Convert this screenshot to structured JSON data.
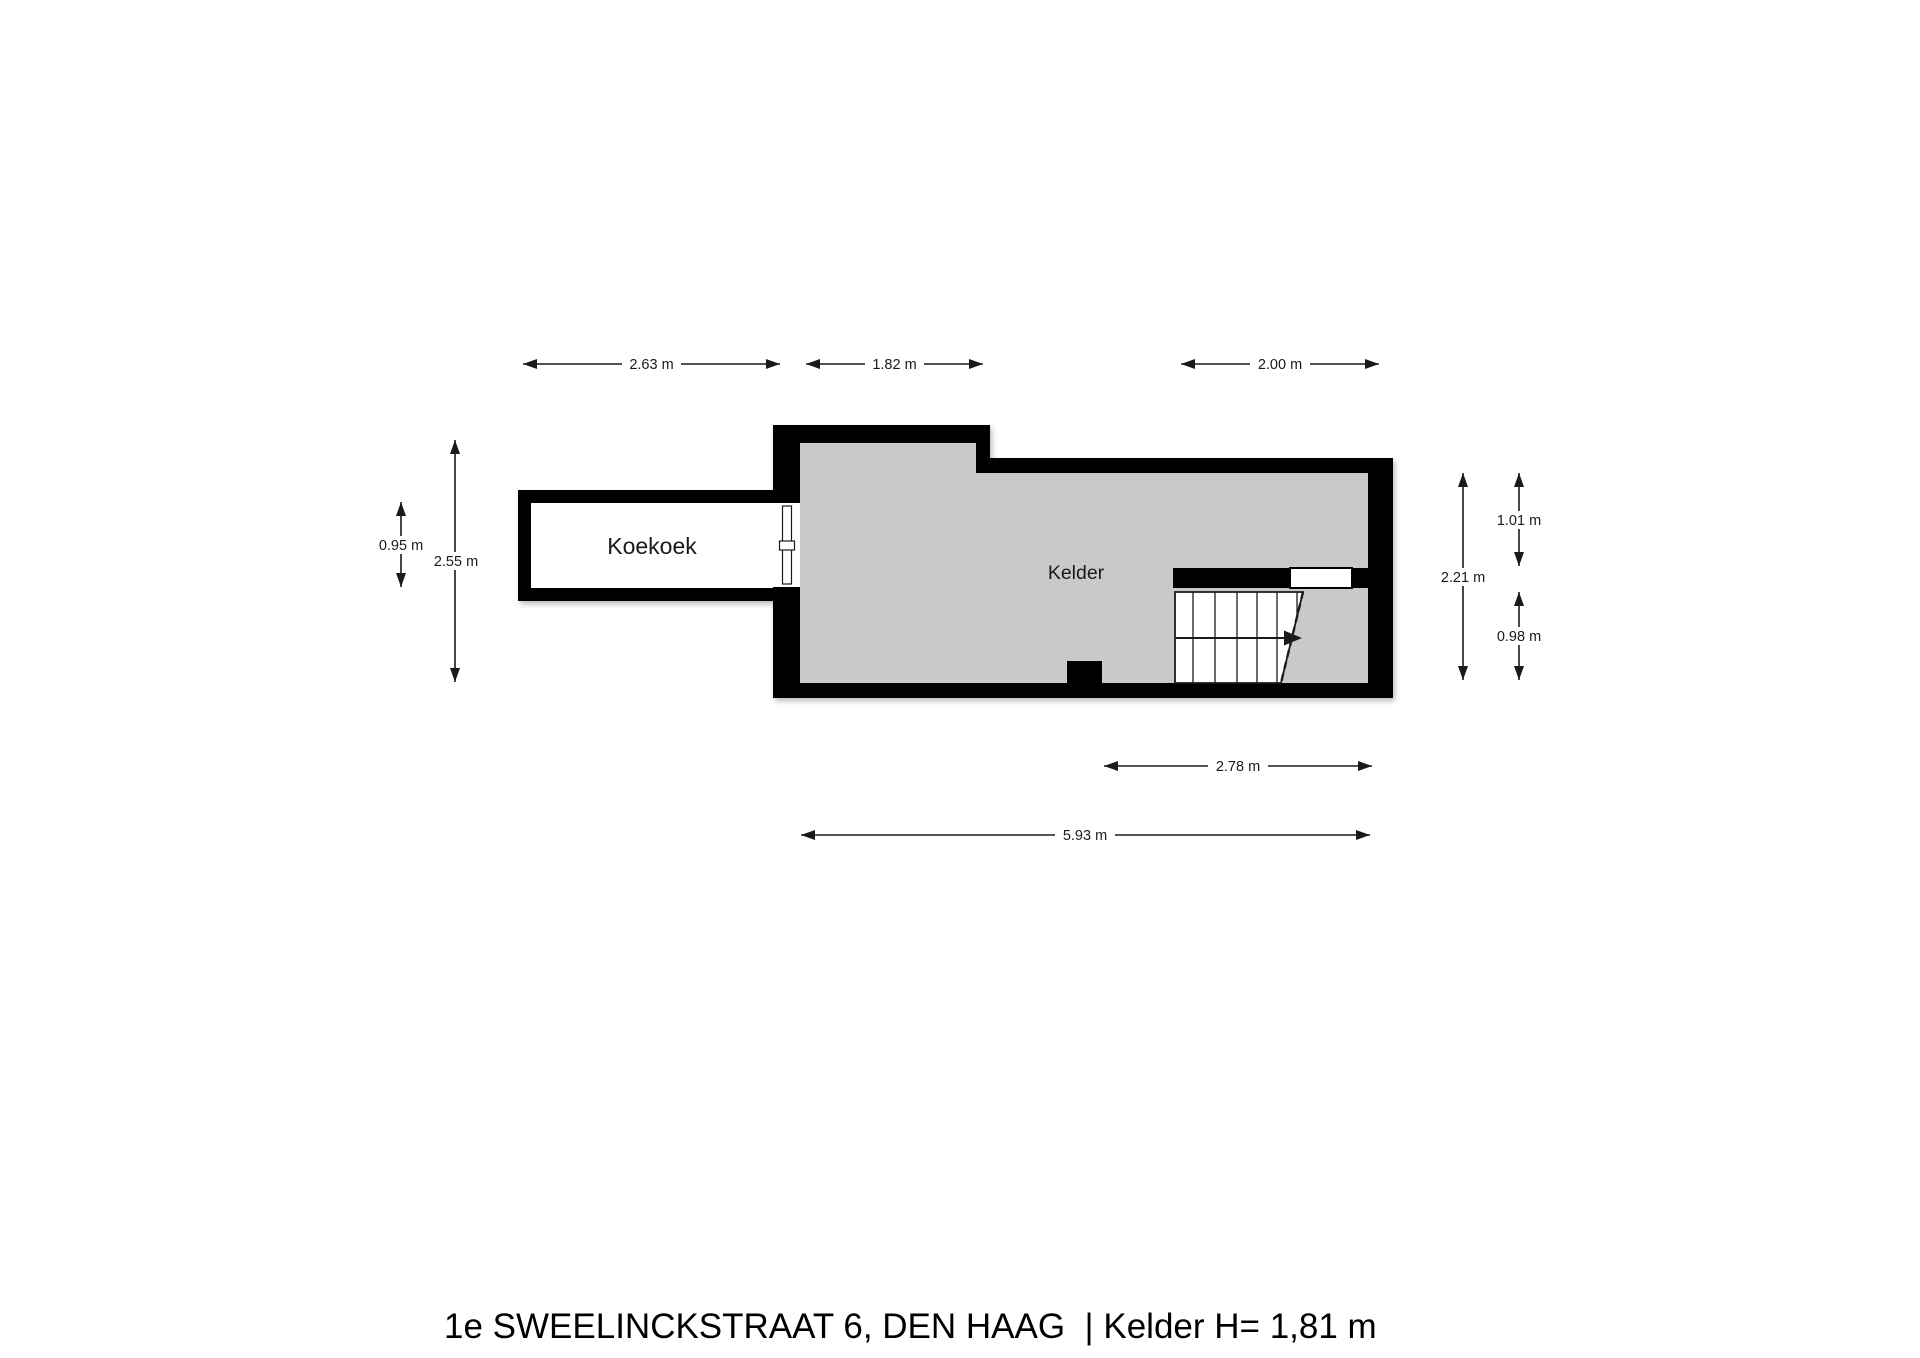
{
  "footer": {
    "text": "1e SWEELINCKSTRAAT 6, DEN HAAG  | Kelder H= 1,81 m"
  },
  "rooms": {
    "koekoek": {
      "label": "Koekoek"
    },
    "kelder": {
      "label": "Kelder"
    }
  },
  "dimensions": {
    "top": [
      {
        "label": "2.63 m"
      },
      {
        "label": "1.82 m"
      },
      {
        "label": "2.00 m"
      }
    ],
    "bottom": [
      {
        "label": "2.78 m"
      },
      {
        "label": "5.93 m"
      }
    ],
    "left": [
      {
        "label": "0.95 m"
      },
      {
        "label": "2.55 m"
      }
    ],
    "right": [
      {
        "label": "2.21 m"
      },
      {
        "label": "1.01 m"
      },
      {
        "label": "0.98 m"
      }
    ]
  },
  "colors": {
    "wall": "#000000",
    "kelder_floor": "#c9c9c9",
    "koekoek_floor": "#ffffff",
    "dimension_text": "#1a1a1a"
  }
}
